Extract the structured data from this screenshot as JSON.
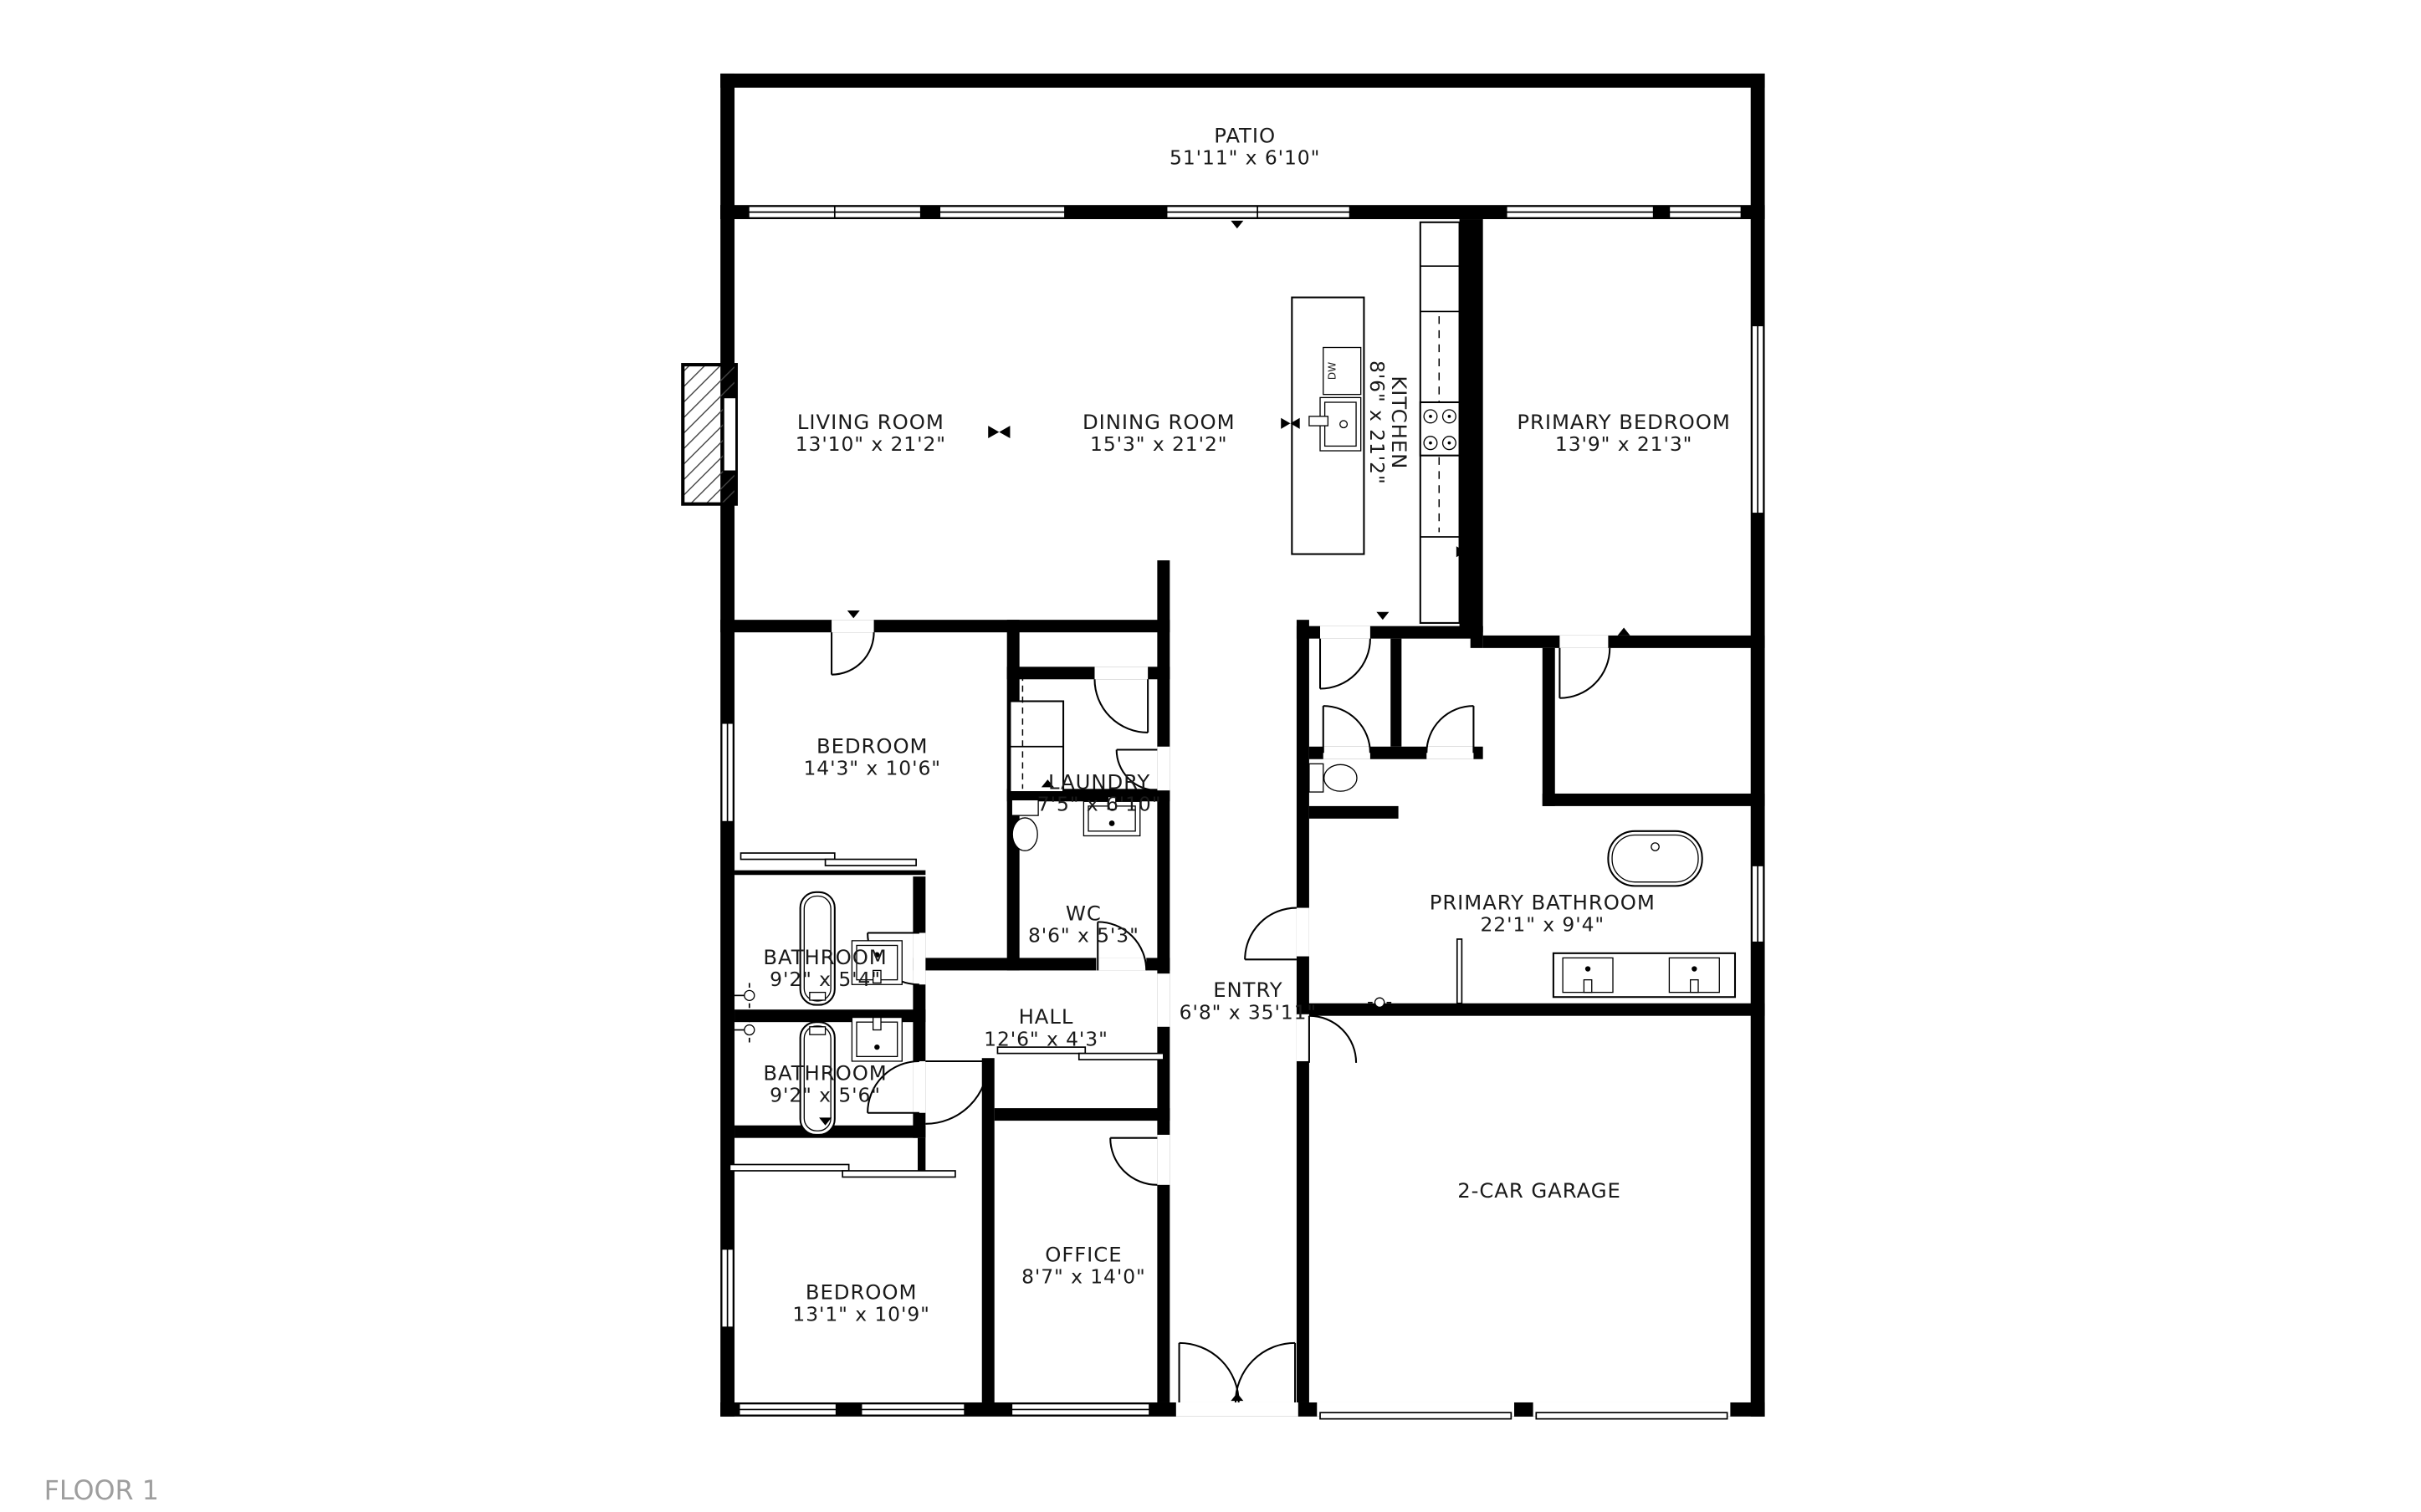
{
  "floor_label": "FLOOR 1",
  "colors": {
    "wall": "#000000",
    "background": "#ffffff",
    "floor_label_text": "#9e9e9e"
  },
  "fixtures": {
    "dishwasher_label": "DW"
  },
  "rooms": [
    {
      "id": "patio",
      "name": "PATIO",
      "dims": "51'11\" x 6'10\""
    },
    {
      "id": "living-room",
      "name": "LIVING ROOM",
      "dims": "13'10\" x 21'2\""
    },
    {
      "id": "dining-room",
      "name": "DINING ROOM",
      "dims": "15'3\" x 21'2\""
    },
    {
      "id": "kitchen",
      "name": "KITCHEN",
      "dims": "8'6\" x 21'2\""
    },
    {
      "id": "primary-bedroom",
      "name": "PRIMARY BEDROOM",
      "dims": "13'9\" x 21'3\""
    },
    {
      "id": "bedroom-top",
      "name": "BEDROOM",
      "dims": "14'3\" x 10'6\""
    },
    {
      "id": "laundry",
      "name": "LAUNDRY",
      "dims": "7'5\" x 6'10\""
    },
    {
      "id": "wc",
      "name": "WC",
      "dims": "8'6\" x 5'3\""
    },
    {
      "id": "bathroom-upper",
      "name": "BATHROOM",
      "dims": "9'2\" x 5'4\""
    },
    {
      "id": "bathroom-lower",
      "name": "BATHROOM",
      "dims": "9'2\" x 5'6\""
    },
    {
      "id": "hall",
      "name": "HALL",
      "dims": "12'6\" x 4'3\""
    },
    {
      "id": "entry",
      "name": "ENTRY",
      "dims": "6'8\" x 35'11\""
    },
    {
      "id": "primary-bathroom",
      "name": "PRIMARY BATHROOM",
      "dims": "22'1\" x 9'4\""
    },
    {
      "id": "garage",
      "name": "2-CAR GARAGE",
      "dims": ""
    },
    {
      "id": "office",
      "name": "OFFICE",
      "dims": "8'7\" x 14'0\""
    },
    {
      "id": "bedroom-bottom",
      "name": "BEDROOM",
      "dims": "13'1\" x 10'9\""
    }
  ]
}
